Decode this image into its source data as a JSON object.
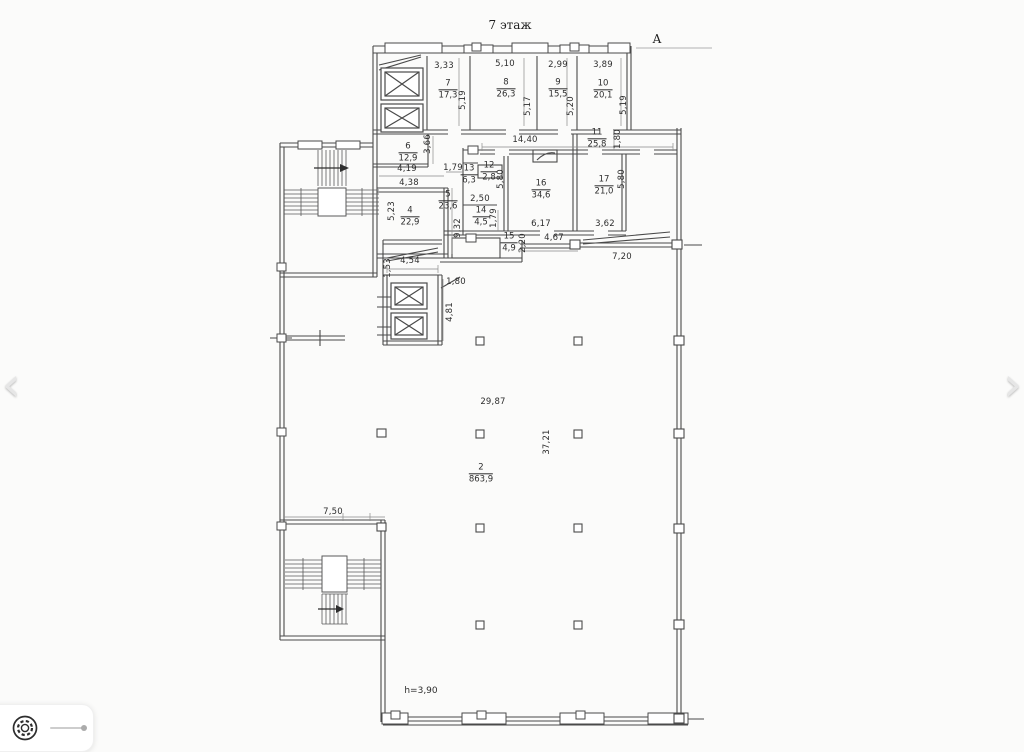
{
  "viewer": {
    "prev_label": "‹",
    "next_label": "›",
    "icons": {
      "prev": "chevron-left-icon",
      "next": "chevron-right-icon",
      "settings": "gear-icon",
      "zoom": "zoom-slider"
    }
  },
  "plan": {
    "title": "7 этаж",
    "axis_label": "A",
    "height_note": "h=3,90",
    "rooms": [
      {
        "num": "7",
        "area": "17,3",
        "x": 448,
        "y": 90
      },
      {
        "num": "8",
        "area": "26,3",
        "x": 506,
        "y": 89
      },
      {
        "num": "9",
        "area": "15,5",
        "x": 558,
        "y": 89
      },
      {
        "num": "10",
        "area": "20,1",
        "x": 603,
        "y": 90
      },
      {
        "num": "6",
        "area": "12,9",
        "x": 408,
        "y": 153
      },
      {
        "num": "11",
        "area": "25,8",
        "x": 597,
        "y": 139
      },
      {
        "num": "13",
        "area": "6,3",
        "x": 469,
        "y": 175
      },
      {
        "num": "12",
        "area": "2,8",
        "x": 489,
        "y": 172
      },
      {
        "num": "16",
        "area": "34,6",
        "x": 541,
        "y": 190
      },
      {
        "num": "17",
        "area": "21,0",
        "x": 604,
        "y": 186
      },
      {
        "num": "5",
        "area": "23,6",
        "x": 448,
        "y": 201
      },
      {
        "num": "4",
        "area": "22,9",
        "x": 410,
        "y": 217
      },
      {
        "num": "14",
        "area": "4,5",
        "x": 481,
        "y": 217
      },
      {
        "num": "15",
        "area": "4,9",
        "x": 509,
        "y": 243
      },
      {
        "num": "2",
        "area": "863,9",
        "x": 481,
        "y": 474
      }
    ],
    "dimensions": [
      {
        "t": "3,33",
        "x": 444,
        "y": 66
      },
      {
        "t": "5,10",
        "x": 505,
        "y": 64
      },
      {
        "t": "2,99",
        "x": 558,
        "y": 65
      },
      {
        "t": "3,89",
        "x": 603,
        "y": 65
      },
      {
        "t": "5,19",
        "x": 463,
        "y": 100,
        "v": 1
      },
      {
        "t": "5,17",
        "x": 528,
        "y": 106,
        "v": 1
      },
      {
        "t": "5,20",
        "x": 571,
        "y": 106,
        "v": 1
      },
      {
        "t": "5,19",
        "x": 624,
        "y": 105,
        "v": 1
      },
      {
        "t": "14,40",
        "x": 525,
        "y": 140
      },
      {
        "t": "1,80",
        "x": 618,
        "y": 139,
        "v": 1
      },
      {
        "t": "3,66",
        "x": 428,
        "y": 144,
        "v": 1
      },
      {
        "t": "4,19",
        "x": 407,
        "y": 169
      },
      {
        "t": "1,79",
        "x": 453,
        "y": 168
      },
      {
        "t": "5,80",
        "x": 501,
        "y": 179,
        "v": 1
      },
      {
        "t": "4,38",
        "x": 409,
        "y": 183
      },
      {
        "t": "5,80",
        "x": 622,
        "y": 179,
        "v": 1
      },
      {
        "t": "5,23",
        "x": 392,
        "y": 211,
        "v": 1
      },
      {
        "t": "2,50",
        "x": 480,
        "y": 199
      },
      {
        "t": "1,79",
        "x": 494,
        "y": 218,
        "v": 1
      },
      {
        "t": "9,32",
        "x": 458,
        "y": 228,
        "v": 1
      },
      {
        "t": "6,17",
        "x": 541,
        "y": 224
      },
      {
        "t": "3,62",
        "x": 605,
        "y": 224
      },
      {
        "t": "4,67",
        "x": 554,
        "y": 238
      },
      {
        "t": "2,20",
        "x": 523,
        "y": 243,
        "v": 1
      },
      {
        "t": "7,20",
        "x": 622,
        "y": 257
      },
      {
        "t": "1,53",
        "x": 388,
        "y": 268,
        "v": 1
      },
      {
        "t": "4,54",
        "x": 410,
        "y": 261
      },
      {
        "t": "1,80",
        "x": 456,
        "y": 282
      },
      {
        "t": "4,81",
        "x": 450,
        "y": 312,
        "v": 1
      },
      {
        "t": "29,87",
        "x": 493,
        "y": 402
      },
      {
        "t": "37,21",
        "x": 547,
        "y": 442,
        "v": 1
      },
      {
        "t": "7,50",
        "x": 333,
        "y": 512
      }
    ]
  }
}
